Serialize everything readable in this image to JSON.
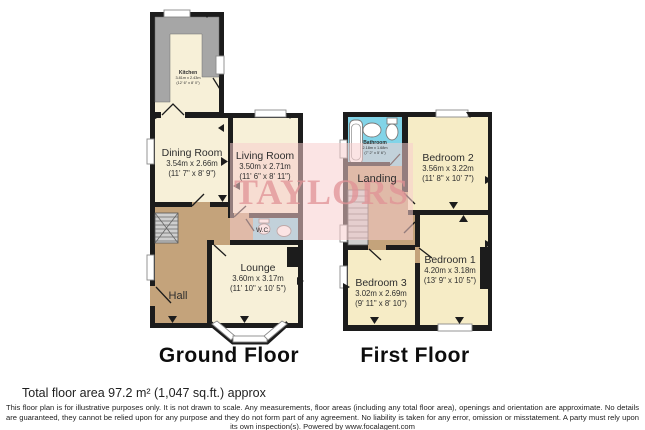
{
  "ground_floor": {
    "title": "Ground Floor",
    "rooms": {
      "kitchen": {
        "name": "Kitchen",
        "dims_m": "3.81m x 2.43m",
        "dims_ft": "(12' 6\" x 8' 0\")"
      },
      "dining": {
        "name": "Dining Room",
        "dims_m": "3.54m x 2.66m",
        "dims_ft": "(11' 7\" x 8' 9\")"
      },
      "living": {
        "name": "Living Room",
        "dims_m": "3.50m x 2.71m",
        "dims_ft": "(11' 6\" x 8' 11\")"
      },
      "wc": {
        "name": "W.C."
      },
      "lounge": {
        "name": "Lounge",
        "dims_m": "3.60m x 3.17m",
        "dims_ft": "(11' 10\" x 10' 5\")"
      },
      "hall": {
        "name": "Hall"
      }
    }
  },
  "first_floor": {
    "title": "First Floor",
    "rooms": {
      "bathroom": {
        "name": "Bathroom",
        "dims_m": "2.18m x 1.68m",
        "dims_ft": "(7' 2\" x 5' 6\")"
      },
      "landing": {
        "name": "Landing"
      },
      "bedroom2": {
        "name": "Bedroom 2",
        "dims_m": "3.56m x 3.22m",
        "dims_ft": "(11' 8\" x 10' 7\")"
      },
      "bedroom1": {
        "name": "Bedroom 1",
        "dims_m": "4.20m x 3.18m",
        "dims_ft": "(13' 9\" x 10' 5\")"
      },
      "bedroom3": {
        "name": "Bedroom 3",
        "dims_m": "3.02m x 2.69m",
        "dims_ft": "(9' 11\" x 8' 10\")"
      }
    }
  },
  "watermark": {
    "text": "TAYLORS"
  },
  "footer": {
    "total_area": "Total floor area 97.2 m² (1,047 sq.ft.) approx",
    "disclaimer": "This floor plan is for illustrative purposes only. It is not drawn to scale. Any measurements, floor areas (including any total floor area), openings and orientation are approximate. No details are guaranteed, they cannot be relied upon for any purpose and they do not form part of any agreement. No liability is taken for any error, omission or misstatement. A party must rely upon its own inspection(s). Powered by www.focalagent.com"
  },
  "colors": {
    "walls": "#1c1c1c",
    "room_cream": "#f7f0d8",
    "bedroom_yellow": "#f6ecc6",
    "hall_brown": "#c4a37b",
    "wet_room_blue": "#82d4e8",
    "counter_gray": "#a6a6a6",
    "watermark_pink": "#f4cccc"
  }
}
